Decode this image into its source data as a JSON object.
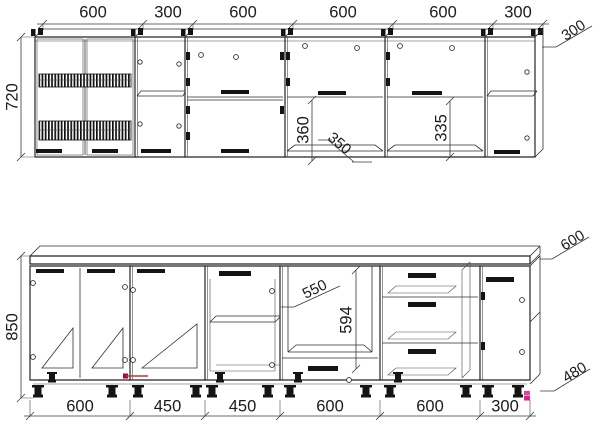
{
  "drawing": {
    "type": "kitchen-cabinet-technical-drawing",
    "upper_run": {
      "width_labels": [
        "600",
        "300",
        "600",
        "600",
        "600",
        "300"
      ],
      "height_label": "720",
      "depth_label": "300",
      "open_niche_height_label": "360",
      "shelf_depth_label": "350",
      "niche_height_label": "335"
    },
    "lower_run": {
      "width_labels": [
        "600",
        "450",
        "450",
        "600",
        "600",
        "300"
      ],
      "height_label": "850",
      "worktop_depth_label": "600",
      "side_height_label": "480",
      "oven_niche_depth_label": "550",
      "oven_niche_height_label": "594"
    },
    "colors": {
      "line": "#242424",
      "dimension": "#3a3a3a",
      "highlight_red": "#c23333",
      "highlight_magenta": "#e93fa2",
      "background": "#ffffff"
    }
  }
}
